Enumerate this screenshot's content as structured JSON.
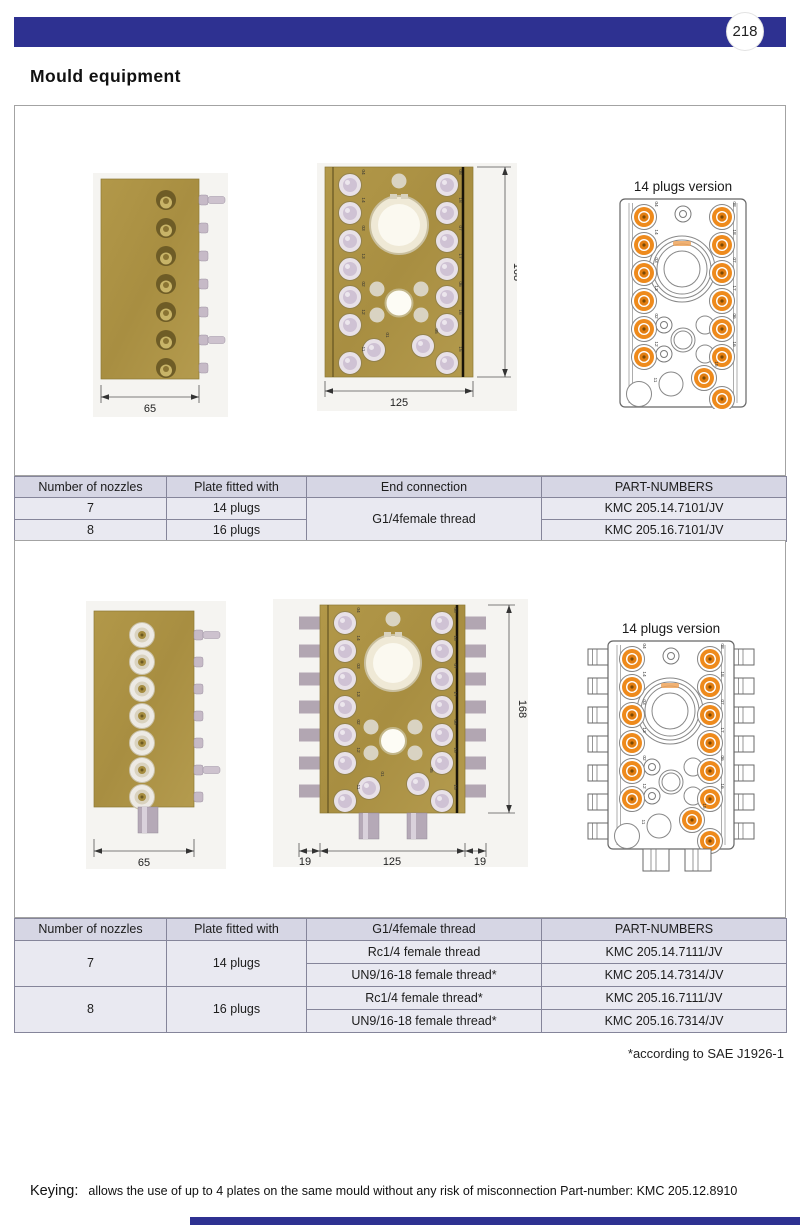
{
  "page": {
    "number": "218",
    "title": "Mould equipment"
  },
  "colors": {
    "accent": "#2e3191",
    "brass": "#ad9347",
    "plug_orange": "#ee8a1c"
  },
  "d1": {
    "caption": "14 plugs version",
    "dim_width_side": "65",
    "dim_width_front": "125",
    "dim_height": "168",
    "plugs_left": [
      "04",
      "14",
      "03",
      "13",
      "02",
      "12",
      "11"
    ],
    "plugs_right": [
      "08",
      "18",
      "07",
      "17",
      "06",
      "16",
      "15"
    ],
    "plugs_inset": [
      "01",
      "05"
    ]
  },
  "d2": {
    "caption": "14 plugs version",
    "dim_width_side": "65",
    "dim_offset_left": "19",
    "dim_width_front": "125",
    "dim_offset_right": "19",
    "dim_height": "168",
    "plugs_left": [
      "04",
      "14",
      "03",
      "13",
      "02",
      "12",
      "11"
    ],
    "plugs_right": [
      "08",
      "18",
      "07",
      "17",
      "06",
      "16",
      "15"
    ],
    "plugs_inset": [
      "01",
      "05"
    ]
  },
  "table1": {
    "headers": [
      "Number of nozzles",
      "Plate fitted with",
      "End connection",
      "PART-NUMBERS"
    ],
    "row1": {
      "nozzles": "7",
      "plate": "14 plugs",
      "end": "G1/4female thread",
      "part": "KMC 205.14.7101/JV"
    },
    "row2": {
      "nozzles": "8",
      "plate": "16 plugs",
      "part": "KMC 205.16.7101/JV"
    }
  },
  "table2": {
    "headers": [
      "Number of nozzles",
      "Plate fitted with",
      "G1/4female thread",
      "PART-NUMBERS"
    ],
    "group1": {
      "nozzles": "7",
      "plate": "14 plugs",
      "row1": {
        "end": "Rc1/4 female thread",
        "part": "KMC 205.14.7111/JV"
      },
      "row2": {
        "end": "UN9/16-18 female thread*",
        "part": "KMC 205.14.7314/JV"
      }
    },
    "group2": {
      "nozzles": "8",
      "plate": "16 plugs",
      "row1": {
        "end": "Rc1/4 female thread*",
        "part": "KMC 205.16.7111/JV"
      },
      "row2": {
        "end": "UN9/16-18 female thread*",
        "part": "KMC 205.16.7314/JV"
      }
    }
  },
  "footnote": "*according to SAE J1926-1",
  "keying": {
    "label": "Keying:",
    "text": "allows the use of up to 4 plates on the same mould without any risk of misconnection  Part-number: KMC 205.12.8910"
  }
}
